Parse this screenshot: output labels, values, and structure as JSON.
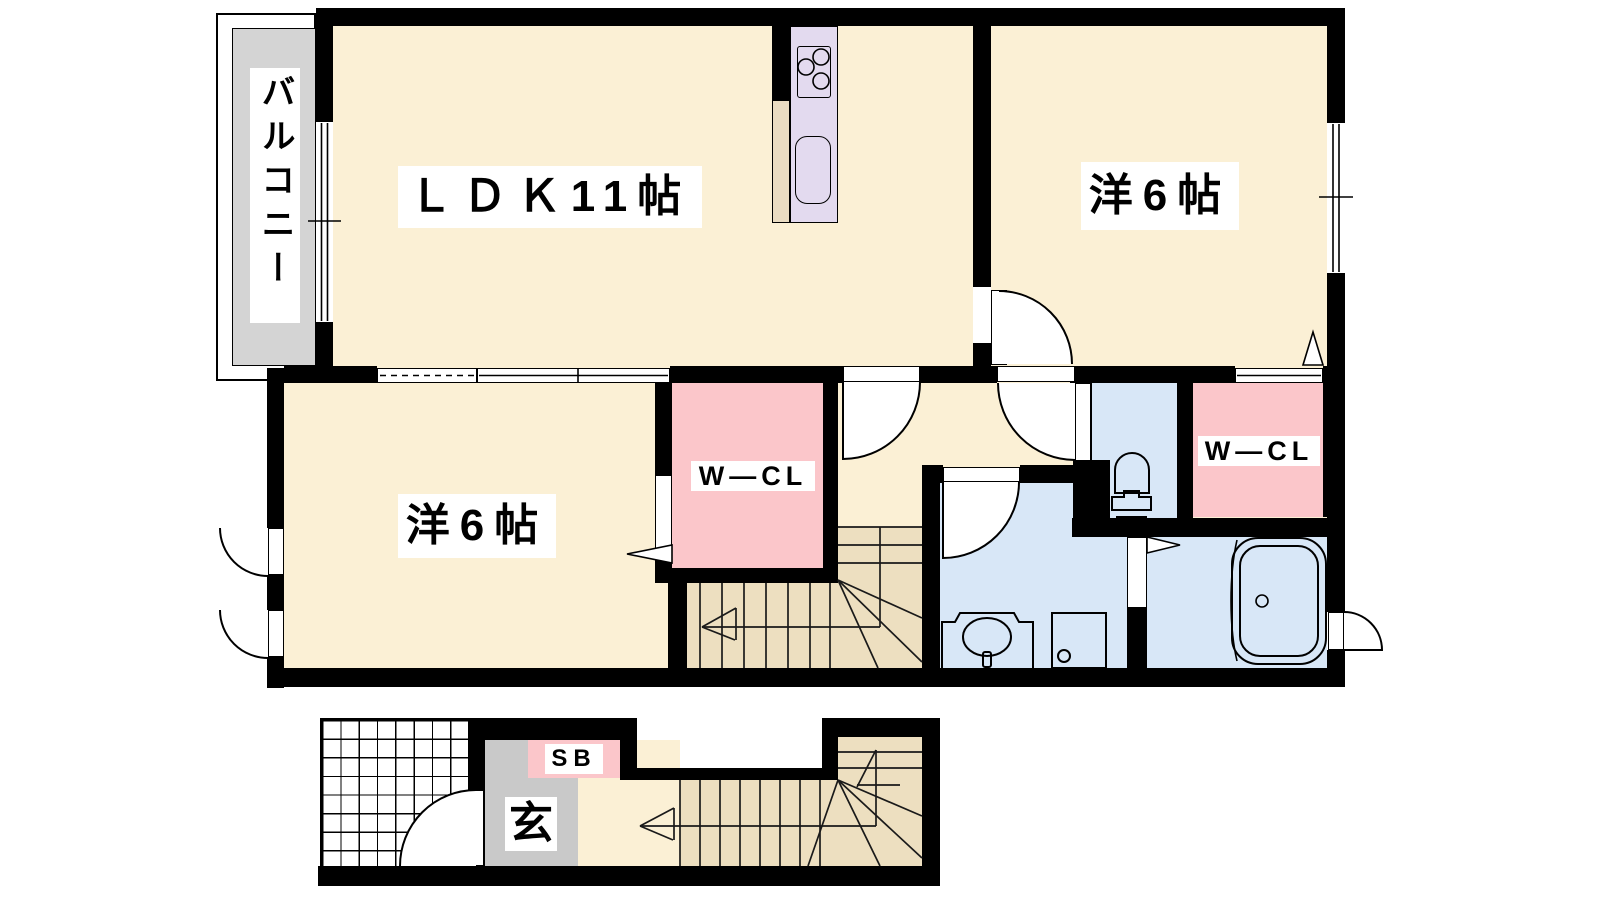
{
  "floorplan": {
    "second_floor": {
      "balcony_label": "バルコニー",
      "ldk_label": "ＬＤＫ11帖",
      "bedroom_right_label": "洋6帖",
      "bedroom_left_label": "洋6帖",
      "wcl_center_label": "W—CL",
      "wcl_right_label": "W—CL"
    },
    "first_floor": {
      "entrance_label": "玄",
      "shoebox_label": "SB"
    },
    "colors": {
      "room_cream": "#FBF0D5",
      "stairs_beige": "#EDDFC0",
      "closet_pink": "#FBC6CA",
      "wet_blue": "#D8E7F7",
      "kitchen_lavender": "#E3DAEF",
      "entrance_gray": "#C9C9C9",
      "balcony_gray": "#D4D4D4",
      "wall_black": "#000000"
    }
  }
}
